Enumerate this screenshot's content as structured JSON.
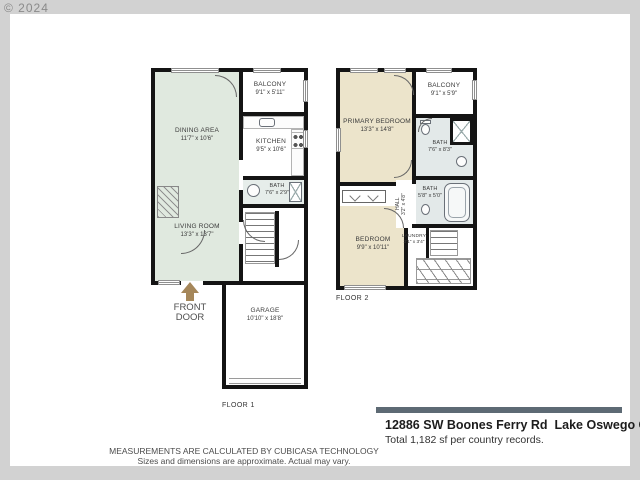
{
  "copyright": "© 2024",
  "floor1": {
    "label": "FLOOR 1",
    "front_door": {
      "line1": "FRONT",
      "line2": "DOOR"
    },
    "rooms": {
      "dining": {
        "name": "DINING AREA",
        "dims": "11'7\" x 10'6\""
      },
      "kitchen": {
        "name": "KITCHEN",
        "dims": "9'5\" x 10'6\""
      },
      "balcony": {
        "name": "BALCONY",
        "dims": "9'1\" x 5'11\""
      },
      "living": {
        "name": "LIVING ROOM",
        "dims": "13'3\" x 13'7\""
      },
      "bath": {
        "name": "BATH",
        "dims": "7'6\" x 2'9\""
      },
      "garage": {
        "name": "GARAGE",
        "dims": "10'10\" x 18'8\""
      }
    }
  },
  "floor2": {
    "label": "FLOOR 2",
    "rooms": {
      "primary_bedroom": {
        "name": "PRIMARY BEDROOM",
        "dims": "13'3\" x 14'8\""
      },
      "balcony": {
        "name": "BALCONY",
        "dims": "9'1\" x 5'9\""
      },
      "bath_upper": {
        "name": "BATH",
        "dims": "7'6\" x 8'3\""
      },
      "bath_lower": {
        "name": "BATH",
        "dims": "5'8\" x 5'0\""
      },
      "hall": {
        "name": "HALL",
        "dims": "3'2\" x 4'8\""
      },
      "laundry": {
        "name": "LAUNDRY",
        "dims": "3'1\" x 3'4\""
      },
      "bedroom": {
        "name": "BEDROOM",
        "dims": "9'9\" x 10'11\""
      }
    }
  },
  "footer": {
    "address": "12886 SW Boones Ferry Rd  Lake Oswego OR",
    "total_sf": "Total 1,182 sf per country records.",
    "disclaimer_line1": "MEASUREMENTS ARE CALCULATED BY CUBICASA TECHNOLOGY",
    "disclaimer_line2": "Sizes and dimensions are approximate.  Actual may vary."
  },
  "colors": {
    "page_background": "#d2d2d2",
    "wall": "#141414",
    "living_area_fill": "#e0e9df",
    "bedroom_fill": "#ece4cb",
    "bath_fill": "#e3e9e9",
    "address_bar": "#5d6a74",
    "front_door_arrow": "#a5875a"
  }
}
